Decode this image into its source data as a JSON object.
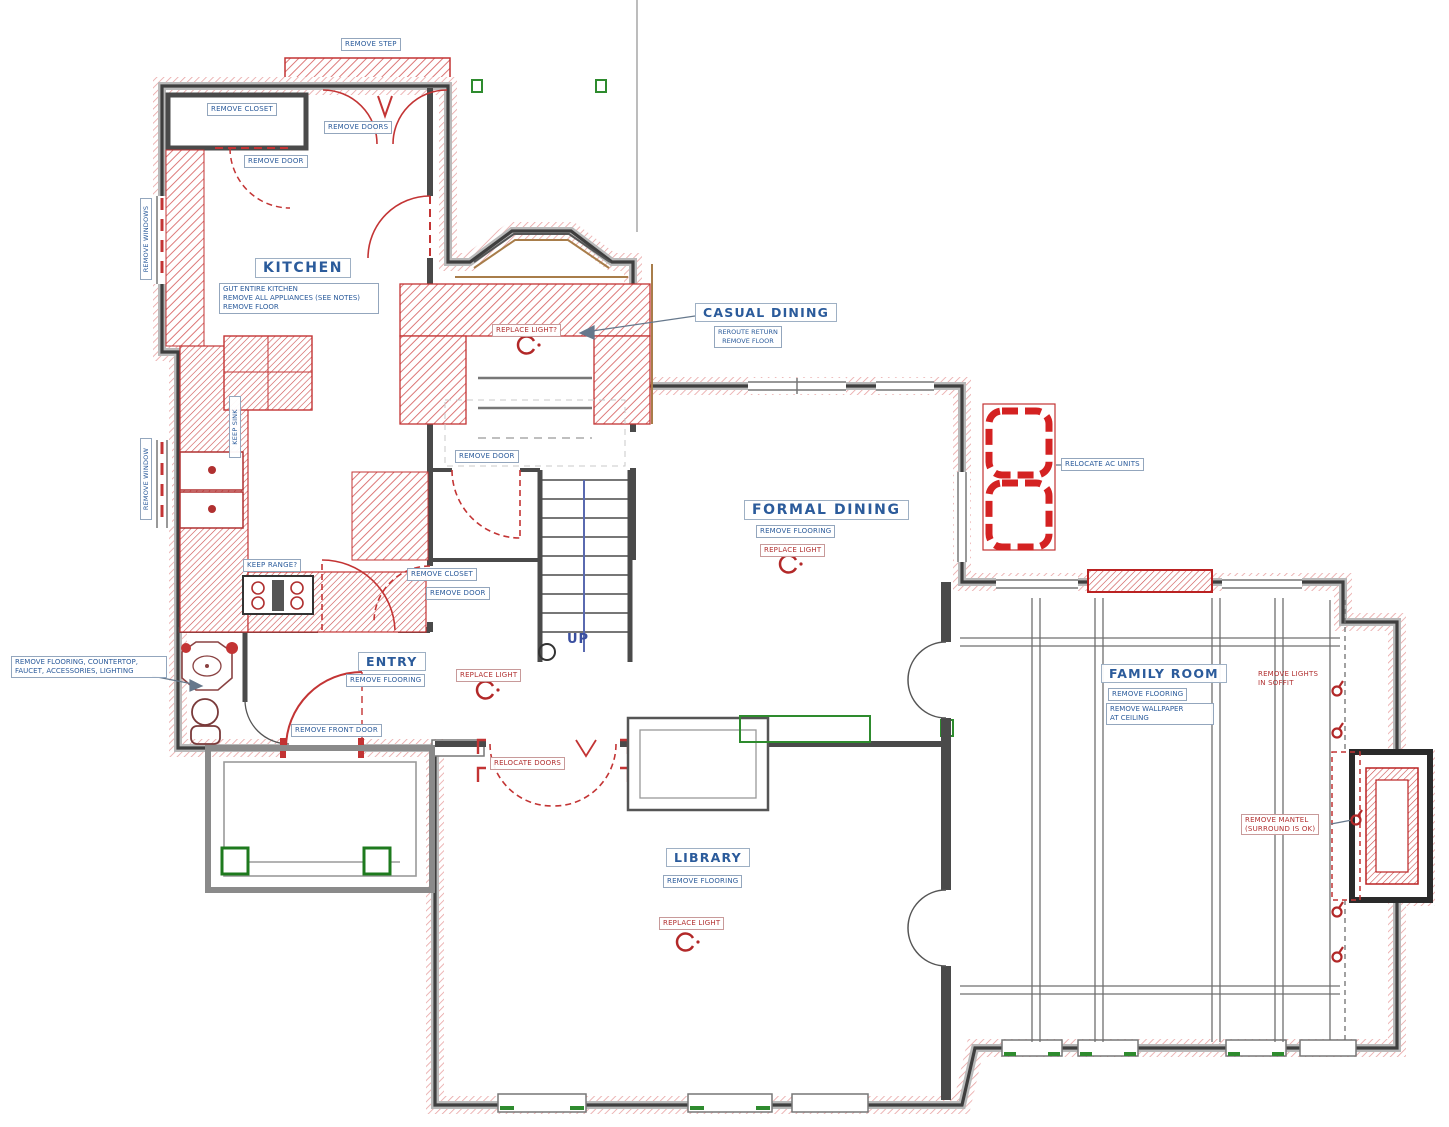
{
  "meta": {
    "title": "First Floor Demolition Plan"
  },
  "colors": {
    "blue_text": "#2b5b9b",
    "red_demo": "#c33434",
    "green_accent": "#2e8b2e",
    "wall_gray": "#3f3f3f",
    "tan_trim": "#a87d4a"
  },
  "rooms": {
    "kitchen": {
      "name": "KITCHEN",
      "notes": "GUT ENTIRE KITCHEN\nREMOVE ALL APPLIANCES (SEE NOTES)\nREMOVE FLOOR"
    },
    "casual_dining": {
      "name": "CASUAL DINING",
      "notes": "REROUTE RETURN\nREMOVE FLOOR"
    },
    "formal_dining": {
      "name": "FORMAL DINING",
      "notes": "REMOVE FLOORING"
    },
    "entry": {
      "name": "ENTRY",
      "notes": "REMOVE FLOORING"
    },
    "library": {
      "name": "LIBRARY",
      "notes": "REMOVE FLOORING"
    },
    "family_room": {
      "name": "FAMILY ROOM",
      "notes": "REMOVE FLOORING",
      "ceiling_note": "REMOVE WALLPAPER\nAT CEILING"
    }
  },
  "labels": {
    "remove_step": "REMOVE STEP",
    "remove_closet_mud": "REMOVE CLOSET",
    "remove_doors_mud": "REMOVE DOORS",
    "remove_door_mud": "REMOVE DOOR",
    "remove_windows_a": "REMOVE WINDOWS",
    "remove_window_b": "REMOVE WINDOW",
    "keep_sink": "KEEP SINK",
    "keep_range": "KEEP RANGE?",
    "replace_light_nook": "REPLACE LIGHT?",
    "remove_door_hall": "REMOVE DOOR",
    "remove_closet_hall": "REMOVE CLOSET",
    "remove_door_hall2": "REMOVE DOOR",
    "up": "UP",
    "relocate_ac": "RELOCATE AC UNITS",
    "replace_light_fd": "REPLACE LIGHT",
    "replace_light_entry": "REPLACE LIGHT",
    "remove_front_door": "REMOVE FRONT DOOR",
    "relocate_doors": "RELOCATE DOORS",
    "replace_light_lib": "REPLACE LIGHT",
    "powder_note": "REMOVE FLOORING, COUNTERTOP,\nFAUCET, ACCESSORIES, LIGHTING",
    "remove_lights_soffit": "REMOVE LIGHTS\nIN SOFFIT",
    "remove_mantel": "REMOVE MANTEL\n(SURROUND IS OK)"
  }
}
